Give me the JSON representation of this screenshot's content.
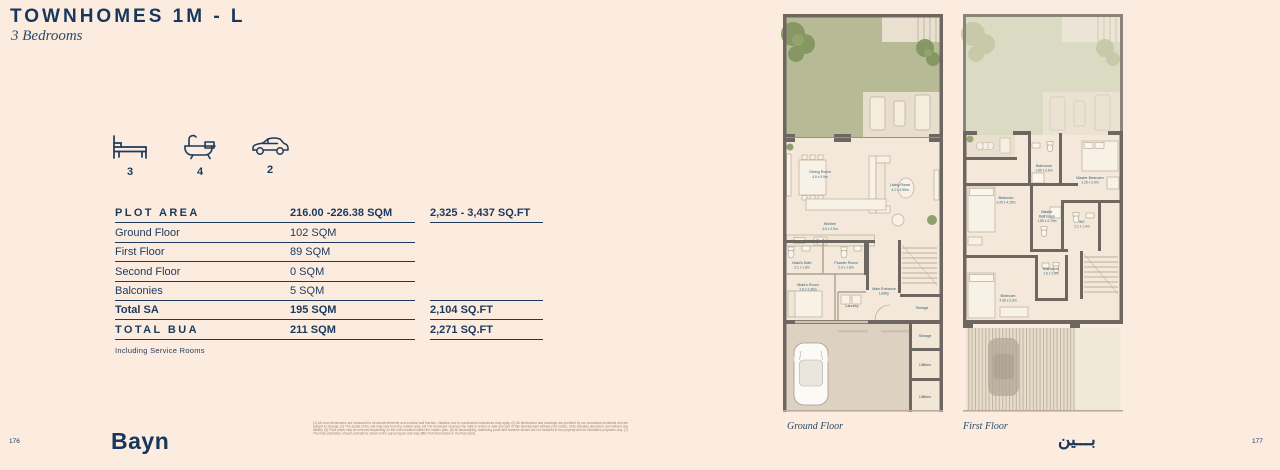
{
  "page": {
    "title": "TOWNHOMES 1M - L",
    "subtitle": "3 Bedrooms",
    "left_page_number": "176",
    "right_page_number": "177",
    "brand_latin": "Bayn",
    "brand_arabic": "بـــين"
  },
  "features": {
    "bed": {
      "icon": "bed-icon",
      "count": "3"
    },
    "bath": {
      "icon": "bathtub-icon",
      "count": "4"
    },
    "car": {
      "icon": "car-icon",
      "count": "2"
    }
  },
  "area_table": {
    "rows": [
      {
        "label": "PLOT AREA",
        "sqm": "216.00 -226.38 SQM",
        "sqft": "2,325 - 3,437 SQ.FT"
      },
      {
        "label": "Ground Floor",
        "sqm": "102 SQM",
        "sqft": ""
      },
      {
        "label": "First Floor",
        "sqm": "89 SQM",
        "sqft": ""
      },
      {
        "label": "Second Floor",
        "sqm": "0 SQM",
        "sqft": ""
      },
      {
        "label": "Balconies",
        "sqm": "5 SQM",
        "sqft": ""
      },
      {
        "label": "Total SA",
        "sqm": "195 SQM",
        "sqft": "2,104 SQ.FT"
      },
      {
        "label": "TOTAL BUA",
        "sqm": "211 SQM",
        "sqft": "2,271 SQ.FT"
      }
    ],
    "footnote": "Including Service Rooms"
  },
  "ground_floor": {
    "caption": "Ground Floor",
    "rooms": {
      "dining": {
        "name": "Dining Room",
        "dims": "4.6 x 3.9m"
      },
      "living": {
        "name": "Living Room",
        "dims": "4.1 x 5.95m"
      },
      "kitchen": {
        "name": "Kitchen",
        "dims": "4.6 x 2.5m"
      },
      "maids_bath": {
        "name": "Maid's Bath",
        "dims": "2.1 x 1.8m"
      },
      "powder": {
        "name": "Powder Room",
        "dims": "2.0 x 1.8m"
      },
      "maids_room": {
        "name": "Maid's Room",
        "dims": "2.8 x 2.35m"
      },
      "lobby_line1": "Main Entrance",
      "lobby_line2": "Lobby",
      "laundry": "Laundry",
      "storage_inner": "Storage",
      "storage_outer": "Storage",
      "utilities_1": "Utilities",
      "utilities_2": "Utilities"
    }
  },
  "first_floor": {
    "caption": "First Floor",
    "rooms": {
      "bathroom_top": {
        "name": "Bathroom",
        "dims": "1.85 x 2.6m"
      },
      "master_bedroom": {
        "name": "Master Bedroom",
        "dims": "3.25 x 3.9m"
      },
      "bedroom_left": {
        "name": "Bedroom",
        "dims": "3.25 x 4.25m"
      },
      "master_bathroom": {
        "name": "Master",
        "name2": "Bathroom",
        "dims": "1.85 x 2.75m"
      },
      "wc": {
        "name": "WC",
        "dims": "2.1 x 1.9m"
      },
      "bathroom_mid": {
        "name": "Bathroom",
        "dims": "1.9 x 2.6m"
      },
      "bedroom_bottom": {
        "name": "Bedroom",
        "dims": "4.35 x 3.3m"
      }
    }
  },
  "disclaimer": {
    "text": "(1) All room dimensions are measured to structural elements and exclude wall finishes. Variation due to construction tolerances may apply. (2) All dimensions and drawings are provided by our consultant architects and are subject to change. (3) The actual of the unit may vary from the related area. (4) The developer reserves the right to revise or alter any part of this development without prior notice, at its absolute discretion, and without any liability. (5) Floor plans may be mirrored depending on the unit's location within the master plan. (6) All landscaping, swimming pools and furniture shown are not included in the property and for illustrative purposes only. (7) The final orientation of each unit will be shown in the parcel layout and may differ from that shown in the floor plans."
  },
  "colors": {
    "background": "#fcebdf",
    "navy": "#1b3a5c",
    "wall": "#6e6761",
    "garden": "#b6bb95",
    "interior": "#f4e8da"
  }
}
